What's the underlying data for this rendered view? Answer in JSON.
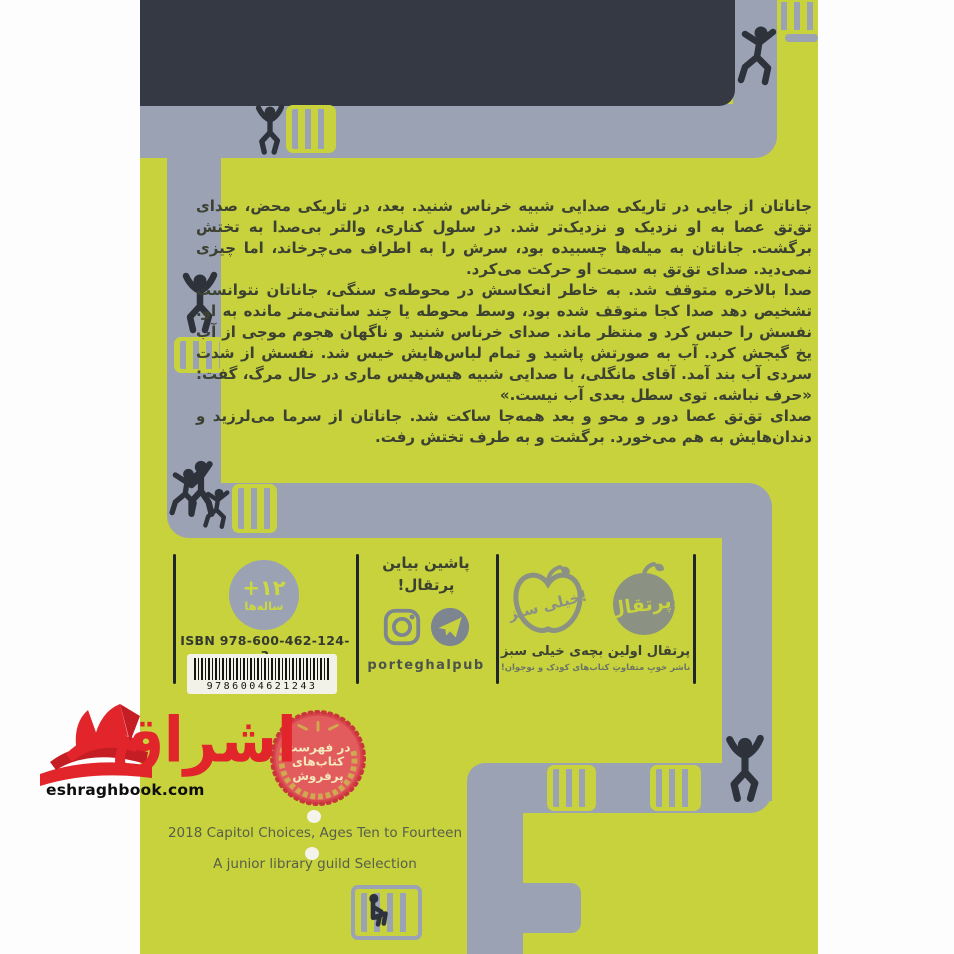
{
  "watermark": {
    "url": "eshraghbook.com",
    "logo_text": "اشراق"
  },
  "cover": {
    "synopsis": {
      "paragraphs": [
        "جاناتان از جایی در تاریکی صدایی شبیه خرناس شنید. بعد، در تاریکی محض، صدای تق‌تق عصا به او نزدیک و نزدیک‌تر شد. در سلول کناری، والتر بی‌صدا به تختش برگشت. جاناتان به میله‌ها چسبیده بود، سرش را به اطراف می‌چرخاند، اما چیزی نمی‌دید. صدای تق‌تق به سمت او حرکت می‌کرد.",
        "صدا بالاخره متوقف شد. به خاطر انعکاسش در محوطه‌ی سنگی، جاناتان نتوانست تشخیص دهد صدا کجا متوقف شده بود، وسط محوطه یا چند سانتی‌متر مانده به او. نفسش را حبس کرد و منتظر ماند. صدای خرناس شنید و ناگهان هجوم موجی از آب یخ گیجش کرد. آب به صورتش پاشید و تمام لباس‌هایش خیس شد. نفسش از شدت سردی آب بند آمد. آقای مانگلی، با صدایی شبیه هیس‌هیس ماری در حال مرگ، گفت: «حرف نباشه. توی سطل بعدی آب نیست.»",
        "صدای تق‌تق عصا دور و محو و بعد همه‌جا ساکت شد. جاناتان از سرما می‌لرزید و دندان‌هایش به هم می‌خورد. برگشت و به طرف تختش رفت."
      ]
    },
    "footer": {
      "age_badge": {
        "value": "+۱۲",
        "label": "ساله‌ها"
      },
      "isbn_label": "ISBN 978-600-462-124-3",
      "barcode_number": "9786004621243",
      "social": {
        "line1": "پاشین بیاین",
        "line2": "پرتقال!",
        "handle": "porteghalpub"
      },
      "publisher": {
        "orange_logo_text": "پرتقال!",
        "apple_logo_text": "خیلی سبز!",
        "tagline": "پرتقال اولین بچه‌ی خیلی سبز",
        "subtitle": "ناشر خوبِ متفاوتِ کتاب‌های کودک و نوجوان!"
      }
    },
    "seal": {
      "line1": "در فهرست",
      "line2": "کتاب‌های",
      "line3": "پرفروش"
    },
    "awards": {
      "line1": "2018 Capitol Choices, Ages Ten to Fourteen",
      "line2": "A junior library guild Selection"
    },
    "colors": {
      "cover_yellow": "#c7d23d",
      "pipe_gray": "#9aa2b4",
      "header_dark": "#343943",
      "silhouette": "#2d323b",
      "accent_red": "#e2242b",
      "seal_red": "#e25c5e",
      "seal_gold": "#cfa94f"
    }
  }
}
